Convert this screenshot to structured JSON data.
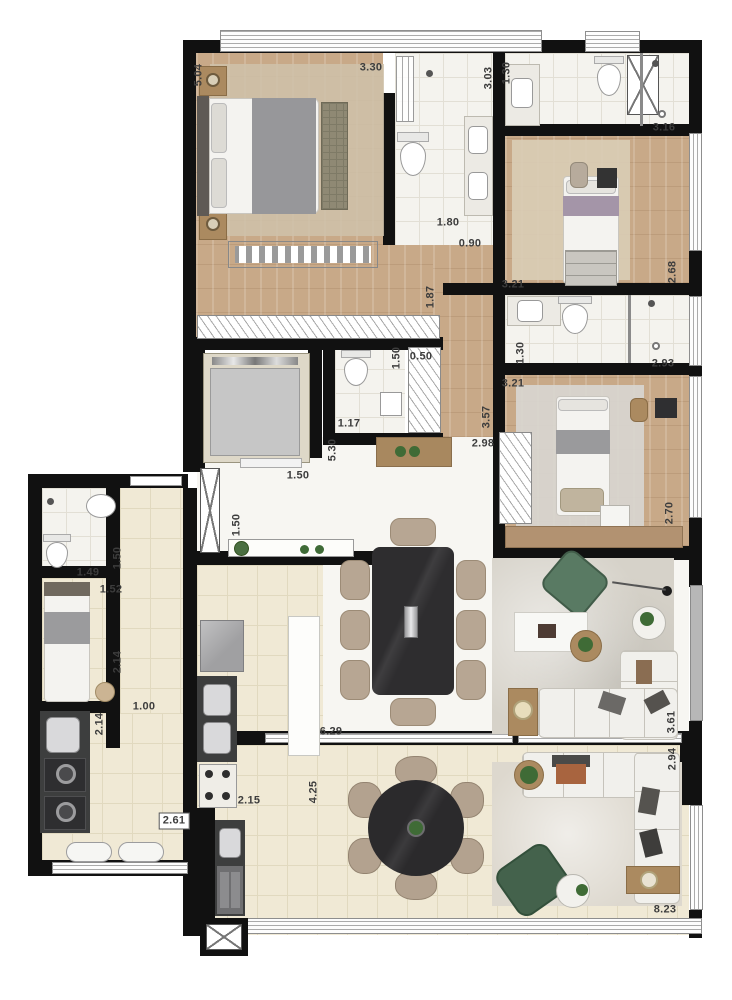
{
  "plan": {
    "type": "residential-apartment-floor-plan",
    "dimension_labels": [
      {
        "text": "5.04",
        "x": 199,
        "y": 75,
        "vertical": true,
        "boxed": false
      },
      {
        "text": "3.30",
        "x": 371,
        "y": 68,
        "vertical": false,
        "boxed": false
      },
      {
        "text": "3.03",
        "x": 489,
        "y": 78,
        "vertical": true,
        "boxed": false
      },
      {
        "text": "1.30",
        "x": 507,
        "y": 73,
        "vertical": true,
        "boxed": false
      },
      {
        "text": "3.16",
        "x": 664,
        "y": 128,
        "vertical": false,
        "boxed": false
      },
      {
        "text": "1.80",
        "x": 448,
        "y": 223,
        "vertical": false,
        "boxed": false
      },
      {
        "text": "0.90",
        "x": 470,
        "y": 244,
        "vertical": false,
        "boxed": false
      },
      {
        "text": "2.68",
        "x": 673,
        "y": 272,
        "vertical": true,
        "boxed": false
      },
      {
        "text": "1.87",
        "x": 431,
        "y": 297,
        "vertical": true,
        "boxed": false
      },
      {
        "text": "3.21",
        "x": 513,
        "y": 285,
        "vertical": false,
        "boxed": false
      },
      {
        "text": "1.30",
        "x": 521,
        "y": 353,
        "vertical": true,
        "boxed": false
      },
      {
        "text": "2.93",
        "x": 663,
        "y": 364,
        "vertical": false,
        "boxed": false
      },
      {
        "text": "3.21",
        "x": 513,
        "y": 384,
        "vertical": false,
        "boxed": false
      },
      {
        "text": "2.70",
        "x": 670,
        "y": 513,
        "vertical": true,
        "boxed": false
      },
      {
        "text": "1.50",
        "x": 397,
        "y": 358,
        "vertical": true,
        "boxed": false
      },
      {
        "text": "0.50",
        "x": 421,
        "y": 357,
        "vertical": false,
        "boxed": false
      },
      {
        "text": "1.17",
        "x": 349,
        "y": 424,
        "vertical": false,
        "boxed": false
      },
      {
        "text": "5.30",
        "x": 333,
        "y": 450,
        "vertical": true,
        "boxed": false
      },
      {
        "text": "3.57",
        "x": 487,
        "y": 417,
        "vertical": true,
        "boxed": false
      },
      {
        "text": "2.98",
        "x": 483,
        "y": 444,
        "vertical": false,
        "boxed": false
      },
      {
        "text": "1.50",
        "x": 298,
        "y": 476,
        "vertical": false,
        "boxed": false
      },
      {
        "text": "1.50",
        "x": 237,
        "y": 525,
        "vertical": true,
        "boxed": false
      },
      {
        "text": "1.49",
        "x": 88,
        "y": 573,
        "vertical": false,
        "boxed": false
      },
      {
        "text": "1.50",
        "x": 118,
        "y": 558,
        "vertical": true,
        "boxed": false
      },
      {
        "text": "1.52",
        "x": 111,
        "y": 590,
        "vertical": false,
        "boxed": false
      },
      {
        "text": "2.14",
        "x": 118,
        "y": 662,
        "vertical": true,
        "boxed": false
      },
      {
        "text": "2.14",
        "x": 100,
        "y": 724,
        "vertical": true,
        "boxed": false
      },
      {
        "text": "1.00",
        "x": 144,
        "y": 707,
        "vertical": false,
        "boxed": false
      },
      {
        "text": "2.61",
        "x": 174,
        "y": 821,
        "vertical": false,
        "boxed": true
      },
      {
        "text": "2.15",
        "x": 249,
        "y": 801,
        "vertical": false,
        "boxed": false
      },
      {
        "text": "4.25",
        "x": 314,
        "y": 792,
        "vertical": true,
        "boxed": false
      },
      {
        "text": "6.29",
        "x": 331,
        "y": 732,
        "vertical": false,
        "boxed": false
      },
      {
        "text": "3.61",
        "x": 672,
        "y": 722,
        "vertical": true,
        "boxed": false
      },
      {
        "text": "2.94",
        "x": 673,
        "y": 759,
        "vertical": true,
        "boxed": false
      },
      {
        "text": "8.23",
        "x": 665,
        "y": 910,
        "vertical": false,
        "boxed": false
      }
    ],
    "colors": {
      "wall": "#111111",
      "wood": "#c8a988",
      "tile": "#f4f3ee",
      "tileLine": "#e2dfd5",
      "beige": "#f0e9d5",
      "beigeLine": "#e1d9bf",
      "marble": "#f7f6f2",
      "label": "#3d3d3d",
      "rugBeige": "#cfc2aa",
      "rugGray": "#d7d4cc",
      "counter": "#3d3e3e",
      "metal": "#d8d8da",
      "woodFurn": "#ab8a60",
      "tableDark": "#2e2d2f",
      "chair": "#b7a693",
      "plantGreen": "#3f6b36",
      "sofaGreen": "#597a63",
      "sofa": "#f1f0ec"
    }
  }
}
